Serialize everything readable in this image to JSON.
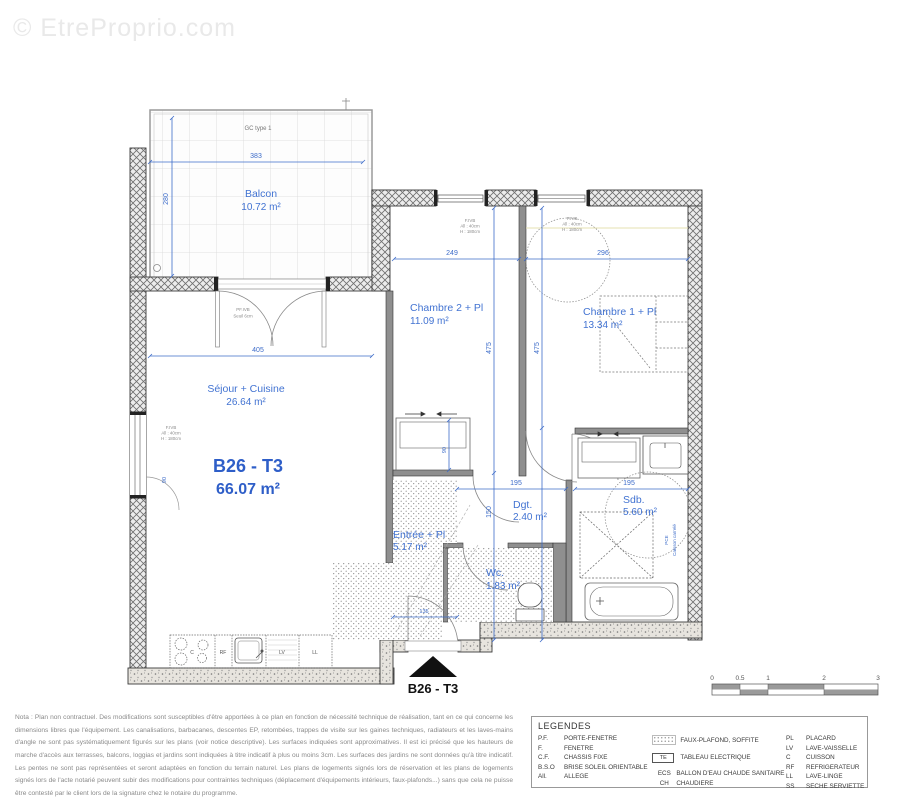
{
  "watermark": {
    "text": "© EtreProprio.com"
  },
  "plan": {
    "unit": {
      "label": "B26 - T3",
      "area": "66.07 m²"
    },
    "entrance_label": "B26 - T3",
    "rooms": [
      {
        "name": "Balcon",
        "area": "10.72 m²"
      },
      {
        "name": "Séjour + Cuisine",
        "area": "26.64 m²"
      },
      {
        "name": "Chambre 2 + Pl",
        "area": "11.09 m²"
      },
      {
        "name": "Chambre 1 + Pl",
        "area": "13.34 m²"
      },
      {
        "name": "Entrée + Pl",
        "area": "5.17 m²"
      },
      {
        "name": "Dgt.",
        "area": "2.40 m²"
      },
      {
        "name": "Wc.",
        "area": "1.83 m²"
      },
      {
        "name": "Sdb.",
        "area": "5.60 m²"
      }
    ],
    "dims": {
      "balcon_w": "383",
      "balcon_h": "280",
      "sejour_w": "405",
      "ch2_w": "249",
      "ch1_w": "296",
      "ch2_h": "475",
      "ch1_h": "475",
      "dgt_h": "150",
      "dgt_w": "195",
      "sdb_w": "195",
      "placard_d": "90",
      "window_w": "90",
      "entree_w": "135"
    },
    "annotations": {
      "gc": "GC type 1",
      "pf_line1": "PF.IVB",
      "pf_line2": "Seuil 6cm",
      "win_line1": "F.IVB",
      "win_line2": "All : 40cm",
      "win_line3": "H : 180cm",
      "te": "TE",
      "kitchen_c": "C",
      "kitchen_rf": "RF",
      "kitchen_lv": "LV",
      "kitchen_ll": "LL",
      "caisson_line1": "PCE",
      "caisson_line2": "Caisson carrelé"
    }
  },
  "scalebar": {
    "labels": [
      "0",
      "0.5",
      "1",
      "2",
      "3"
    ]
  },
  "disclaimer": {
    "text": "Nota : Plan non contractuel. Des modifications sont susceptibles d'être apportées à ce plan en fonction de nécessité technique de réalisation, tant en ce qui concerne les dimensions libres que l'équipement. Les canalisations, barbacanes, descentes EP, retombées, trappes de visite sur les gaines techniques, radiateurs et les laves-mains d'angle ne sont pas systématiquement figurés sur les plans (voir notice descriptive). Les surfaces indiquées sont approximatives. Il est ici précisé que les hauteurs de marche d'accès aux terrasses, balcons, loggias et jardins sont indiquées à titre indicatif à plus ou moins 3cm. Les surfaces des jardins ne sont données qu'à titre indicatif. Les pentes ne sont pas représentées et seront adaptées en fonction du terrain naturel. Les plans de logements signés lors de réservation et les plans de logements signés lors de l'acte notarié peuvent subir des modifications pour contraintes techniques (déplacement d'équipements intérieurs, faux-plafonds...) sans que cela ne puisse être contesté par le client lors de la signature chez le notaire du programme."
  },
  "legend": {
    "title": "LEGENDES",
    "col1": [
      {
        "abbr": "P.F.",
        "label": "PORTE-FENETRE"
      },
      {
        "abbr": "F.",
        "label": "FENETRE"
      },
      {
        "abbr": "C.F.",
        "label": "CHASSIS FIXE"
      },
      {
        "abbr": "B.S.O",
        "label": "BRISE SOLEIL ORIENTABLE"
      },
      {
        "abbr": "All.",
        "label": "ALLEGE"
      }
    ],
    "col2": [
      {
        "abbr": "",
        "label": "FAUX-PLAFOND, SOFFITE"
      },
      {
        "abbr": "TE",
        "label": "TABLEAU ELECTRIQUE"
      },
      {
        "abbr": "ECS",
        "label": "BALLON D'EAU CHAUDE SANITAIRE"
      },
      {
        "abbr": "CH",
        "label": "CHAUDIERE"
      }
    ],
    "col3": [
      {
        "abbr": "PL",
        "label": "PLACARD"
      },
      {
        "abbr": "LV",
        "label": "LAVE-VAISSELLE"
      },
      {
        "abbr": "C",
        "label": "CUISSON"
      },
      {
        "abbr": "RF",
        "label": "REFRIGERATEUR"
      },
      {
        "abbr": "LL",
        "label": "LAVE-LINGE"
      },
      {
        "abbr": "SS",
        "label": "SECHE SERVIETTE"
      }
    ]
  }
}
